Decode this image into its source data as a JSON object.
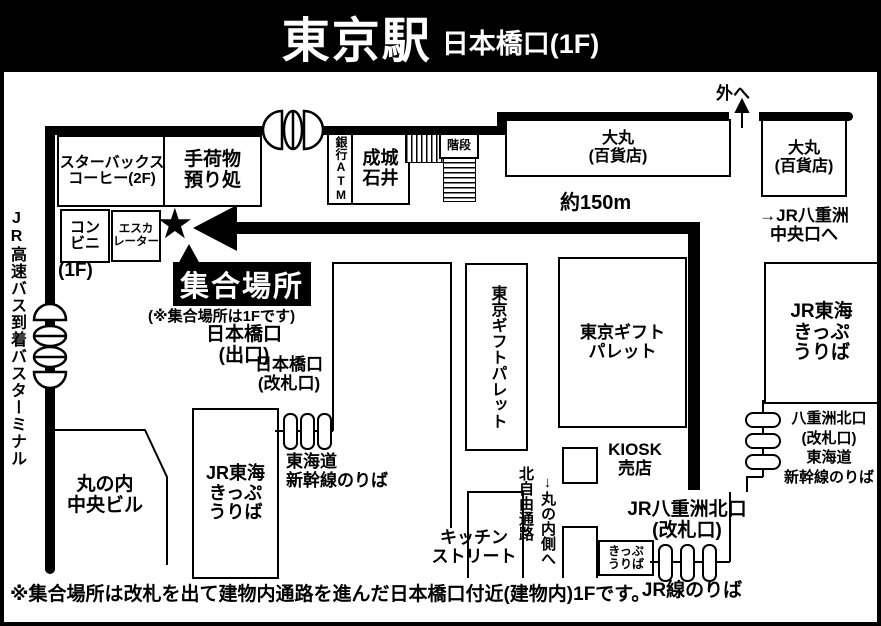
{
  "header": {
    "title": "東京駅",
    "subtitle": "日本橋口(1F)"
  },
  "meeting_point": {
    "star": "★",
    "label": "集合場所",
    "note": "(※集合場所は1Fです)",
    "distance": "約150m"
  },
  "top_area": {
    "starbucks": "スターバックス\nコーヒー(2F)",
    "baggage": "手荷物\n預り処",
    "conbini": "コン\nビニ",
    "escalator": "エスカ\nレーター",
    "floor_1f": "(1F)",
    "bank_atm": "銀行ATM",
    "seijo_ishii": "成城\n石井",
    "stairs": "階段",
    "daimaru_left": "大丸\n(百貨店)",
    "daimaru_right": "大丸\n(百貨店)",
    "outside": "外へ",
    "to_yaesu_central": "→JR八重洲\n中央口へ"
  },
  "left_area": {
    "bus_terminal": "JR高速バス到着バスターミナル",
    "nihonbashi_exit": "日本橋口\n(出口)",
    "marunouchi_bldg": "丸の内\n中央ビル"
  },
  "center_area": {
    "nihonbashi_gate": "日本橋口\n(改札口)",
    "jr_tokai_ticket_left": "JR東海\nきっぷ\nうりば",
    "tokaido_shinkansen_left": "東海道\n新幹線のりば",
    "gift_palette_vertical": "東京ギフトパレット",
    "gift_palette_box": "東京ギフト\nパレット",
    "kitchen_street": "キッチン\nストリート",
    "kita_jiyu_tsuro": "北自由通路",
    "to_marunouchi_side": "↓丸の内側へ",
    "kiosk": "KIOSK\n売店"
  },
  "right_area": {
    "jr_tokai_ticket_right": "JR東海\nきっぷ\nうりば",
    "yaesu_kita_shinkansen": "八重洲北口\n(改札口)\n東海道\n新幹線のりば",
    "jr_yaesu_kita_gate": "JR八重洲北口\n(改札口)",
    "ticket_office_small": "きっぷ\nうりば",
    "jr_line_platform": "JR線のりば"
  },
  "caption": "※集合場所は改札を出て建物内通路を進んだ日本橋口付近(建物内)1Fです。",
  "colors": {
    "ink": "#000000",
    "paper": "#ffffff"
  }
}
